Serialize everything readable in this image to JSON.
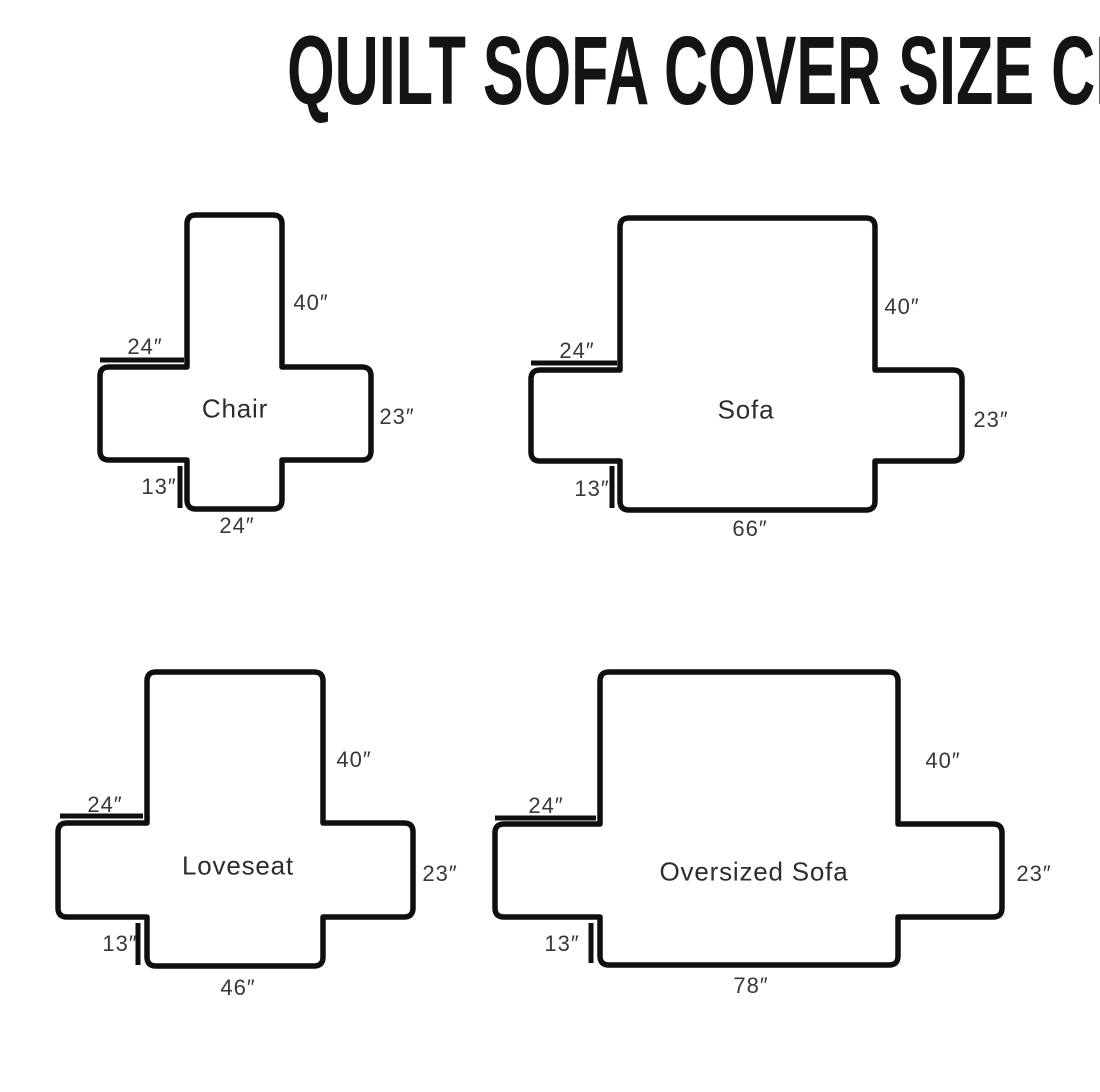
{
  "title": "QUILT SOFA COVER SIZE CHART",
  "unit": "inches",
  "colors": {
    "background": "#ffffff",
    "line": "#0f0f0f",
    "text": "#383838"
  },
  "figures": [
    {
      "name": "Chair",
      "back_height": "40″",
      "arm_top_width": "24″",
      "side_height": "23″",
      "front_drop": "13″",
      "base_width": "24″"
    },
    {
      "name": "Sofa",
      "back_height": "40″",
      "arm_top_width": "24″",
      "side_height": "23″",
      "front_drop": "13″",
      "base_width": "66″"
    },
    {
      "name": "Loveseat",
      "back_height": "40″",
      "arm_top_width": "24″",
      "side_height": "23″",
      "front_drop": "13″",
      "base_width": "46″"
    },
    {
      "name": "Oversized Sofa",
      "back_height": "40″",
      "arm_top_width": "24″",
      "side_height": "23″",
      "front_drop": "13″",
      "base_width": "78″"
    }
  ]
}
